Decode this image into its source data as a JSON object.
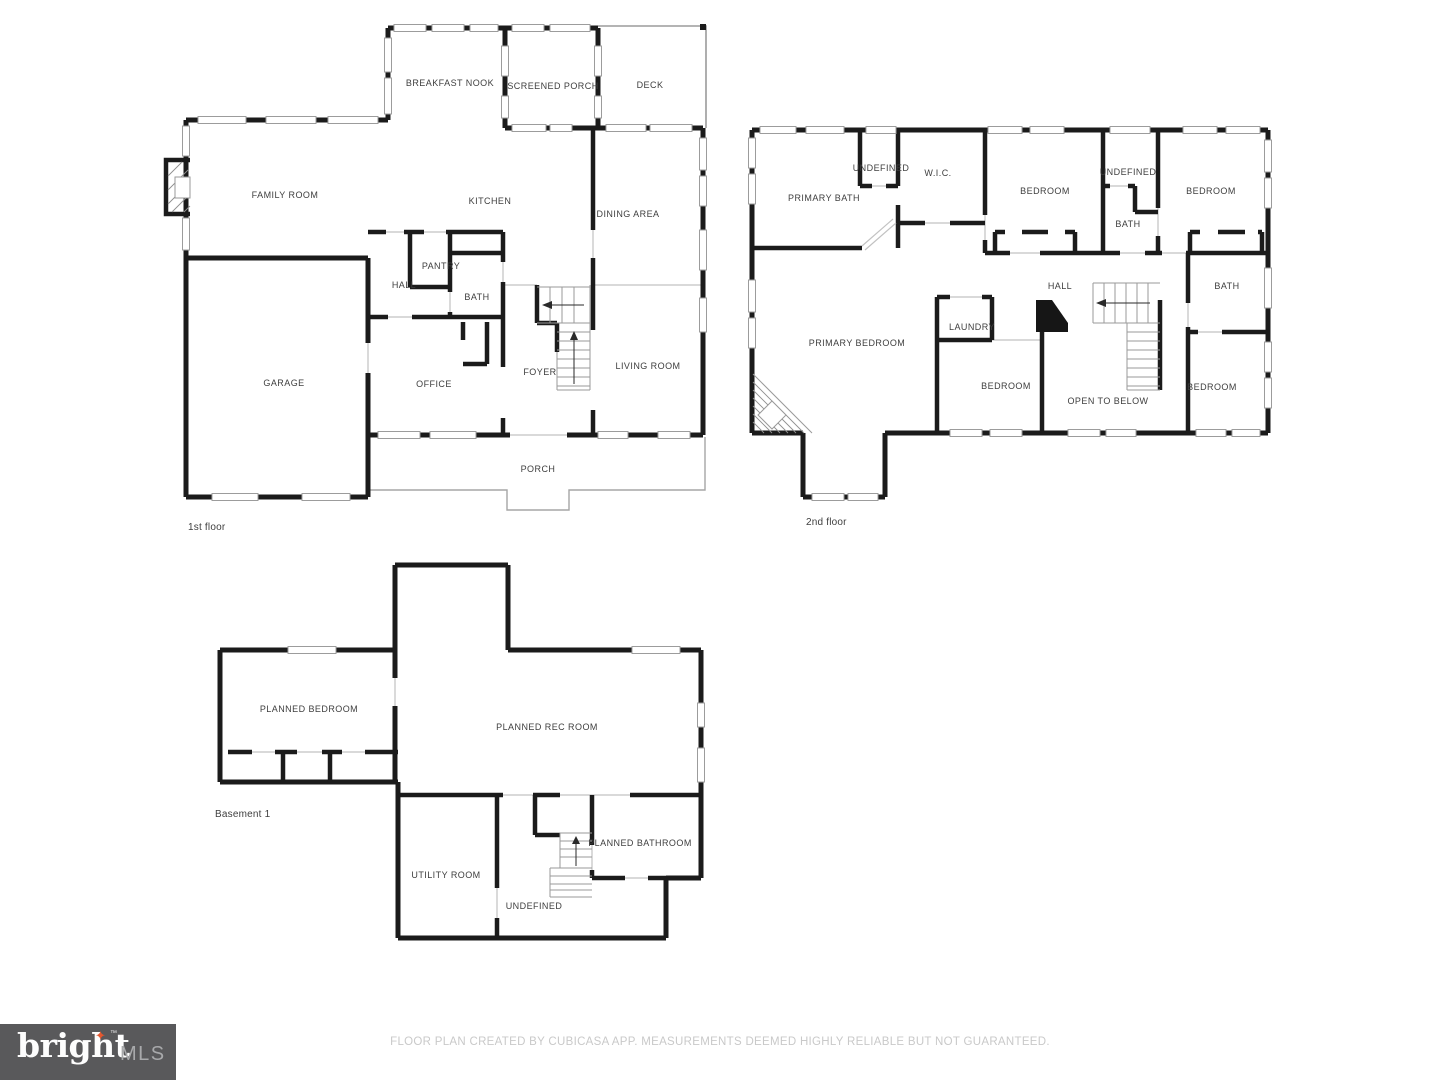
{
  "colors": {
    "wall": "#1b1b1b",
    "room_label": "#3e3e3e",
    "window_outline": "#9c9c9c",
    "stair_line": "#9a9a9a",
    "footer_text": "#c9c9c9",
    "logo_background": "#59595b",
    "logo_brand": "#fdfdfd",
    "logo_suffix": "#a8a9ab",
    "logo_spark": "#e4572e"
  },
  "floors": {
    "first": {
      "floor_label": "1st floor",
      "rooms": [
        {
          "label": "BREAKFAST NOOK"
        },
        {
          "label": "SCREENED PORCH"
        },
        {
          "label": "DECK"
        },
        {
          "label": "FAMILY ROOM"
        },
        {
          "label": "KITCHEN"
        },
        {
          "label": "DINING AREA"
        },
        {
          "label": "PANTRY"
        },
        {
          "label": "HALL"
        },
        {
          "label": "BATH"
        },
        {
          "label": "GARAGE"
        },
        {
          "label": "OFFICE"
        },
        {
          "label": "FOYER"
        },
        {
          "label": "LIVING ROOM"
        },
        {
          "label": "PORCH"
        }
      ]
    },
    "second": {
      "floor_label": "2nd floor",
      "rooms": [
        {
          "label": "PRIMARY BATH"
        },
        {
          "label": "UNDEFINED"
        },
        {
          "label": "W.I.C."
        },
        {
          "label": "BEDROOM"
        },
        {
          "label": "UNDEFINED"
        },
        {
          "label": "BEDROOM"
        },
        {
          "label": "BATH"
        },
        {
          "label": "HALL"
        },
        {
          "label": "BATH"
        },
        {
          "label": "PRIMARY BEDROOM"
        },
        {
          "label": "LAUNDRY"
        },
        {
          "label": "BEDROOM"
        },
        {
          "label": "OPEN TO BELOW"
        },
        {
          "label": "BEDROOM"
        }
      ]
    },
    "basement": {
      "floor_label": "Basement 1",
      "rooms": [
        {
          "label": "PLANNED BEDROOM"
        },
        {
          "label": "PLANNED REC ROOM"
        },
        {
          "label": "UTILITY ROOM"
        },
        {
          "label": "UNDEFINED"
        },
        {
          "label": "PLANNED BATHROOM"
        }
      ]
    }
  },
  "footer": {
    "disclaimer": "FLOOR PLAN CREATED BY CUBICASA APP. MEASUREMENTS DEEMED HIGHLY RELIABLE BUT NOT GUARANTEED."
  },
  "logo": {
    "brand": "bright",
    "tm": "™",
    "suffix": "MLS",
    "spark": "✦"
  }
}
